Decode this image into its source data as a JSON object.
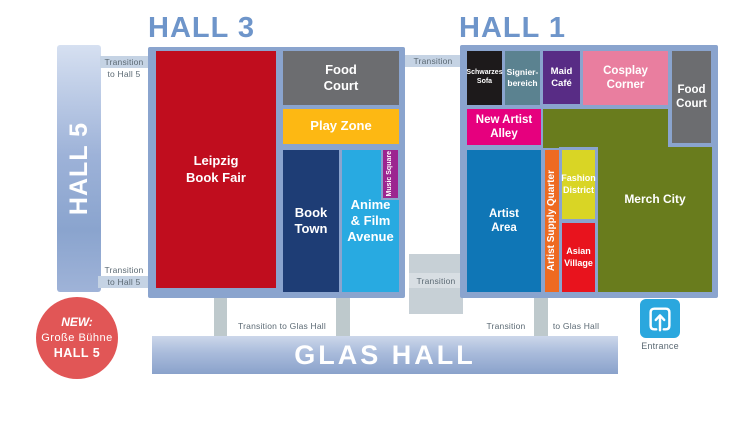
{
  "hall3": {
    "title": "HALL 3",
    "leipzig_book_fair": "Leipzig\nBook Fair",
    "food_court": "Food\nCourt",
    "play_zone": "Play Zone",
    "book_town": "Book\nTown",
    "anime_film_avenue": "Anime\n& Film\nAvenue",
    "music_square": "Music Square"
  },
  "hall1": {
    "title": "HALL 1",
    "schwarzes_sofa": "Schwarzes\nSofa",
    "signierbereich": "Signier-\nbereich",
    "maid_cafe": "Maid\nCafé",
    "cosplay_corner": "Cosplay\nCorner",
    "food_court": "Food\nCourt",
    "new_artist_alley": "New Artist\nAlley",
    "merch_city": "Merch City",
    "artist_area": "Artist\nArea",
    "artist_supply_quarter": "Artist Supply Quarter",
    "fashion_district": "Fashion\nDistrict",
    "asian_village": "Asian\nVillage"
  },
  "hall5": {
    "label": "HALL 5"
  },
  "transitions": {
    "transition": "Transition",
    "to_hall5": "to Hall 5",
    "glas_left": "Transition to Glas Hall",
    "glas_right_a": "Transition",
    "glas_right_b": "to Glas Hall"
  },
  "glas_hall": {
    "title": "GLAS HALL"
  },
  "entrance": {
    "label": "Entrance"
  },
  "new_badge": {
    "line1": "NEW:",
    "line2": "Große Bühne",
    "line3": "HALL 5"
  },
  "colors": {
    "frame": "#8aa4ce",
    "hall_title": "#6e95ca",
    "leipzig_red": "#c00d1e",
    "food_court_gray": "#6c6d70",
    "play_zone_yellow": "#fdb813",
    "book_town_navy": "#1e3d75",
    "anime_blue": "#28aae1",
    "music_square_purple": "#9c2590",
    "schwarzes_black": "#1d1a1b",
    "signier_teal": "#5b8290",
    "maid_purple": "#582c85",
    "cosplay_pink": "#e97e9f",
    "new_artist_magenta": "#e6007e",
    "merch_olive": "#697c1d",
    "artist_blue": "#0f76b6",
    "supply_orange": "#ee6a21",
    "fashion_yellow": "#d9d525",
    "asian_red": "#e8131d",
    "badge_red": "#e15656",
    "entrance_blue": "#2aa7de"
  }
}
